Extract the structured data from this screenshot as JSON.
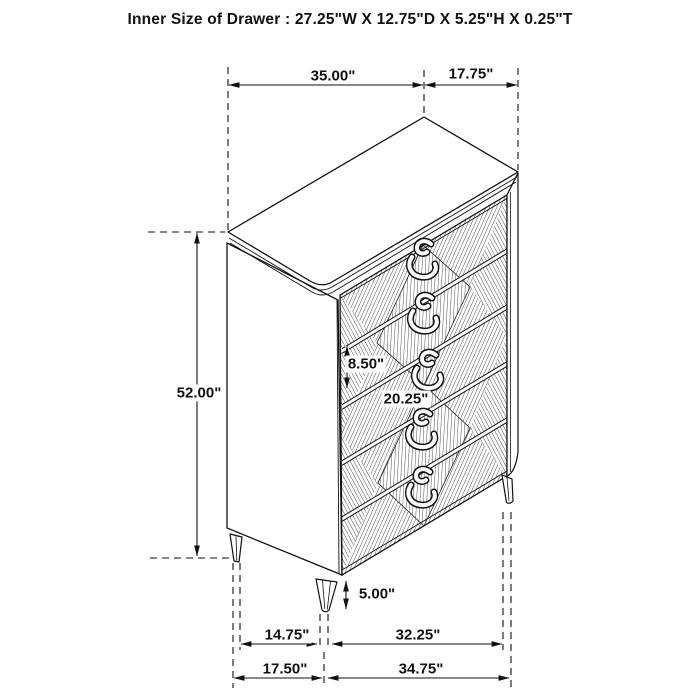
{
  "title": "Inner Size of Drawer : 27.25\"W X 12.75\"D X 5.25\"H X 0.25\"T",
  "dimensions": {
    "top_width": "35.00\"",
    "top_depth": "17.75\"",
    "overall_height": "52.00\"",
    "drawer_face_height": "8.50\"",
    "drawer_face_width": "20.25\"",
    "leg_height": "5.00\"",
    "leg_span_depth_inner": "14.75\"",
    "leg_span_width_inner": "32.25\"",
    "base_depth_outer": "17.50\"",
    "base_width_outer": "34.75\""
  },
  "drawer_count": 5,
  "colors": {
    "line": "#111111",
    "background": "#ffffff",
    "label_background": "#ffffff"
  }
}
